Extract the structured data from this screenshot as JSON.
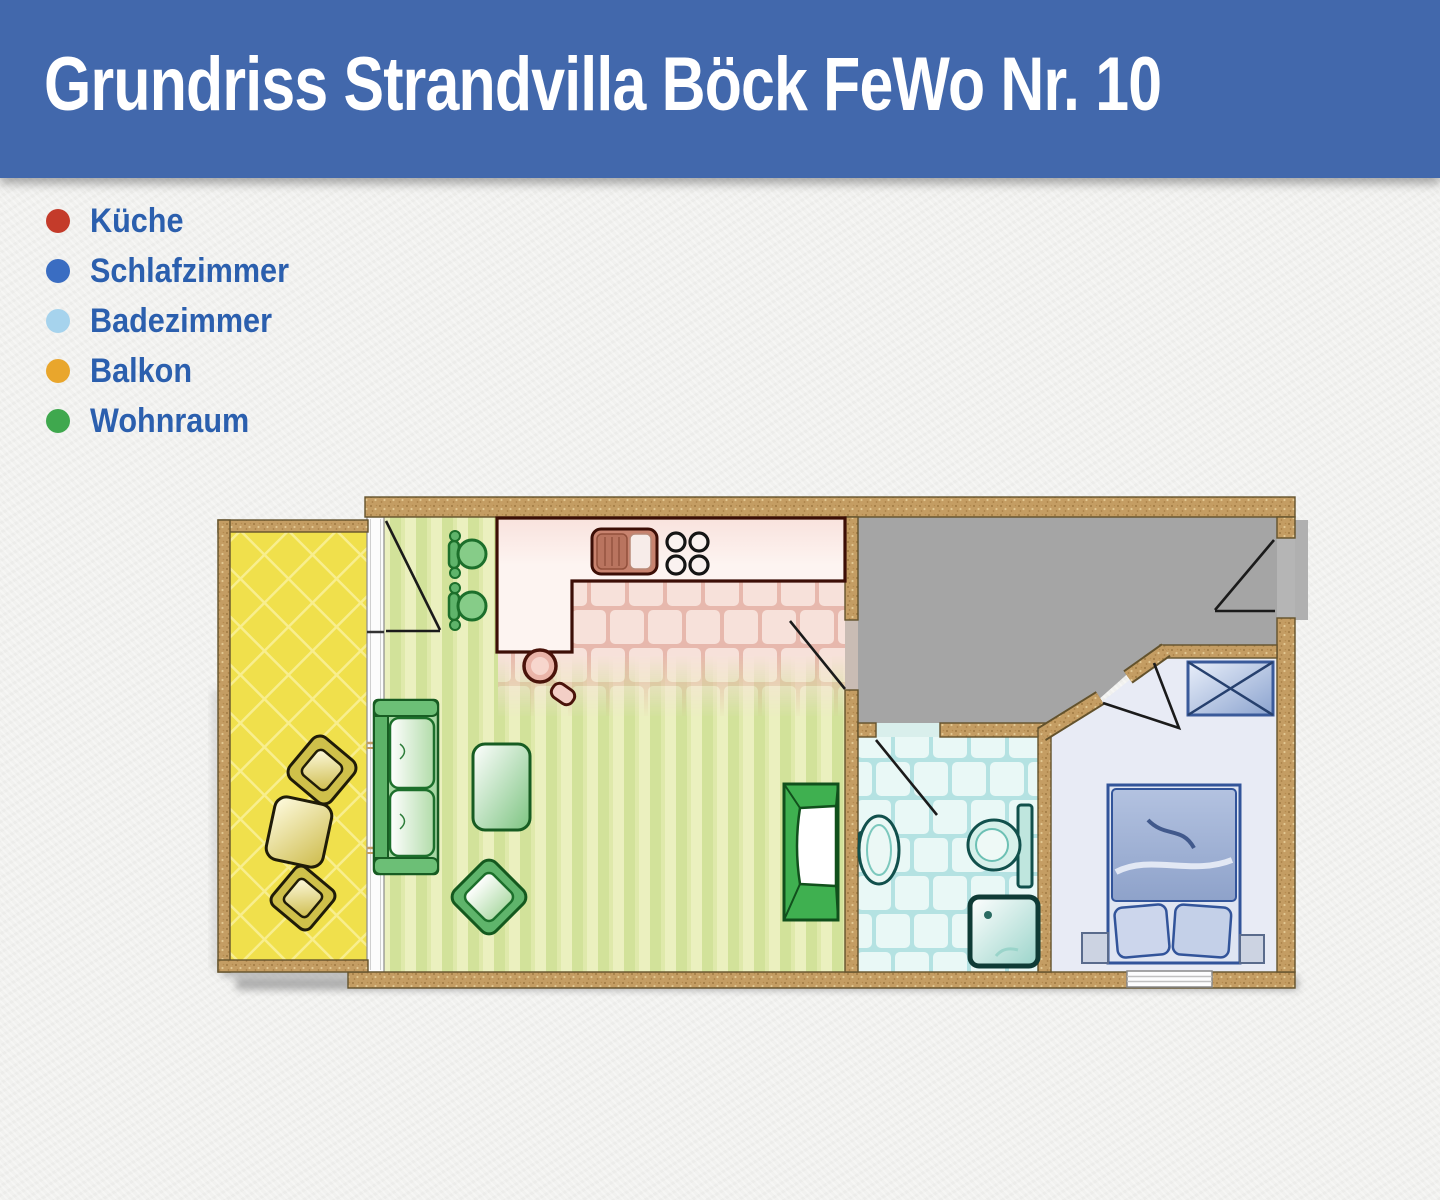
{
  "banner": {
    "title": "Grundriss Strandvilla Böck FeWo Nr. 10",
    "background_color": "#4268ac",
    "text_color": "#ffffff"
  },
  "legend": {
    "label_color": "#2b5fae",
    "items": [
      {
        "label": "Küche",
        "color": "#c43b2a",
        "room": "kitchen"
      },
      {
        "label": "Schlafzimmer",
        "color": "#3a6dc2",
        "room": "bedroom"
      },
      {
        "label": "Badezimmer",
        "color": "#a6d3ed",
        "room": "bathroom"
      },
      {
        "label": "Balkon",
        "color": "#e9a62c",
        "room": "balcony"
      },
      {
        "label": "Wohnraum",
        "color": "#3fa84e",
        "room": "living-room"
      }
    ]
  },
  "floorplan": {
    "wall_color": "#c49d63",
    "wall_outline_color": "#63522c",
    "shadow_color": "#9c9c9c",
    "rooms": [
      {
        "id": "kitchen",
        "floor_style": "pink-tiles",
        "floor_color": "#f7e1da"
      },
      {
        "id": "living-room",
        "floor_style": "green-stripes",
        "floor_color": "#ebf0bf"
      },
      {
        "id": "balcony",
        "floor_style": "yellow-diamonds",
        "floor_color": "#f0e04c"
      },
      {
        "id": "hallway",
        "floor_style": "plain",
        "floor_color": "#a5a5a5"
      },
      {
        "id": "bathroom",
        "floor_style": "cyan-tiles",
        "floor_color": "#e9f8f6"
      },
      {
        "id": "bedroom",
        "floor_style": "plain",
        "floor_color": "#e8ebf5"
      }
    ],
    "furniture": [
      "sun-loungers",
      "sofa",
      "coffee-table",
      "armchair",
      "tv-cabinet",
      "dining-chairs",
      "kitchen-counter",
      "kitchen-sink",
      "stove-burners",
      "bar-stool",
      "bath-sink",
      "toilet",
      "shower",
      "wardrobe",
      "double-bed",
      "nightstands",
      "bedroom-window"
    ]
  }
}
